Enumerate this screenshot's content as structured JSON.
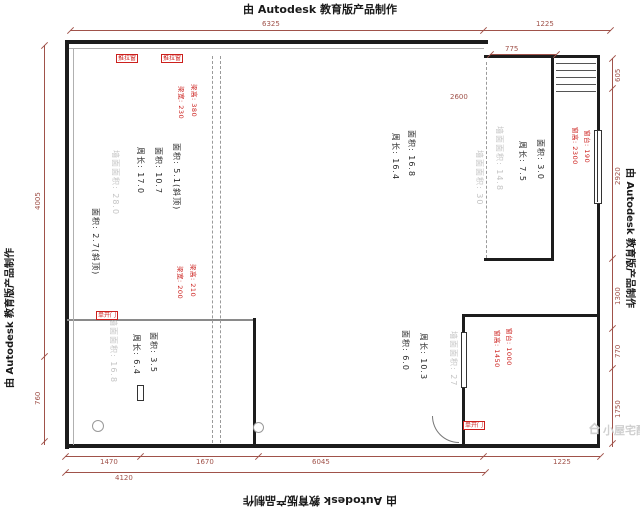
{
  "watermark": {
    "text": "由 Autodesk 教育版产品制作"
  },
  "brand": {
    "logo_text": "小屋宅配"
  },
  "dimensions": {
    "top": [
      "6325",
      "1225",
      "775"
    ],
    "left": [
      "4005",
      "760"
    ],
    "right": [
      "605",
      "2920",
      "1300",
      "770",
      "1750"
    ],
    "bottom": [
      "1470",
      "1670",
      "6045",
      "1225",
      "4120"
    ],
    "inner": [
      "2600"
    ]
  },
  "rooms": {
    "left_loft": {
      "area_sloped": "面积: 5.1(斜顶)",
      "area": "面积: 10.7",
      "perimeter": "周长: 17.0",
      "wall_area": "墙面面积: 28.0",
      "area_sloped2": "面积: 2.7(斜顶)"
    },
    "center": {
      "area": "面积: 16.8",
      "perimeter": "周长: 16.4",
      "wall_area": "墙面面积: 30"
    },
    "top_right": {
      "area": "面积: 3.0",
      "perimeter": "周长: 7.5",
      "wall_area": "墙面面积: 14.8"
    },
    "bottom_right": {
      "area": "面积: 6.0",
      "perimeter": "周长: 10.3",
      "wall_area": "墙面面积: 27"
    },
    "bottom_left": {
      "area": "面积: 3.5",
      "perimeter": "周长: 6.4",
      "wall_area": "墙面面积: 16.8"
    }
  },
  "annotations": {
    "beam_top": {
      "height": "梁高: 380",
      "width": "梁宽: 230"
    },
    "beam_mid": {
      "height": "梁高: 210",
      "width": "梁宽: 200"
    },
    "window_top_right": {
      "height": "窗高: 2300",
      "sill": "窗台: 190"
    },
    "window_bottom_right": {
      "height": "窗高: 1450",
      "sill": "窗台: 1000"
    }
  },
  "tags": {
    "window1": "推拉窗",
    "window2": "推拉窗",
    "door1": "单开门",
    "door2": "单开门"
  },
  "colors": {
    "dimension": "#9e4b43",
    "annotation_red": "#cc201d",
    "wall_text_gray": "#c4c4c4",
    "line_black": "#1c1c1c"
  }
}
